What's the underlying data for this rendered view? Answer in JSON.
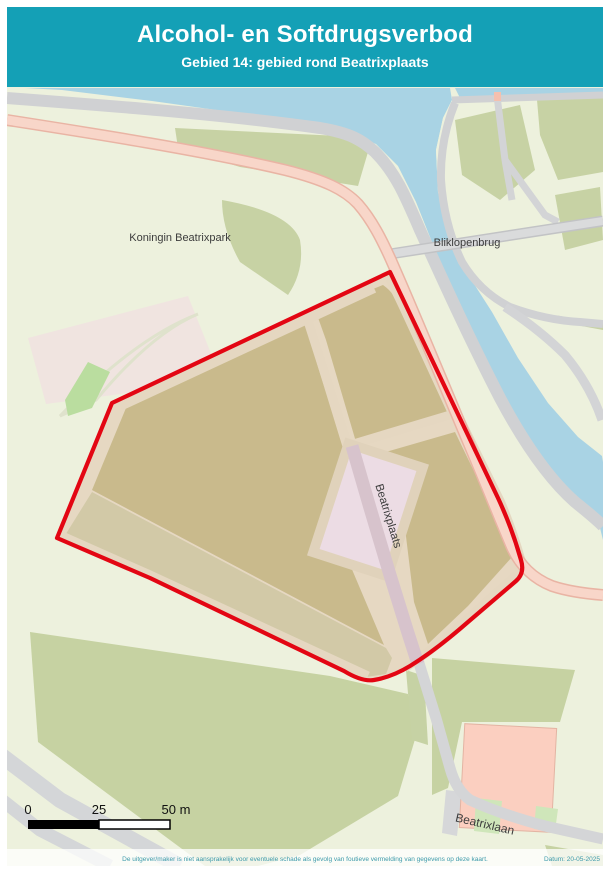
{
  "header": {
    "title": "Alcohol- en Softdrugsverbod",
    "subtitle": "Gebied 14: gebied rond Beatrixplaats",
    "background_color": "#14a0b6",
    "text_color": "#ffffff"
  },
  "map_labels": {
    "park": "Koningin Beatrixpark",
    "bridge": "Bliklopenbrug",
    "square": "Beatrixplaats",
    "street": "Beatrixlaan"
  },
  "scale_bar": {
    "tick0": "0",
    "tick1": "25",
    "tick2": "50 m"
  },
  "zone": {
    "outline_color": "#e30613"
  },
  "map_colors": {
    "water": "#a9d3e4",
    "park_light_green": "#edf1dd",
    "field_green": "#c6d2a2",
    "dark_green_patch": "#c7d2a4",
    "market_area_tan": "#c9ba8c",
    "path_beige": "#e5d7c1",
    "salmon_road": "#f8d6c9",
    "plaza_pink": "#ecdce4",
    "building_salmon": "#fbcfc0",
    "road_gray": "#d2d3d5"
  },
  "footer": {
    "disclaimer": "De uitgever/maker is niet aansprakelijk voor eventuele schade als gevolg van foutieve vermelding van gegevens op deze kaart.",
    "date": "Datum: 20-05-2025"
  }
}
